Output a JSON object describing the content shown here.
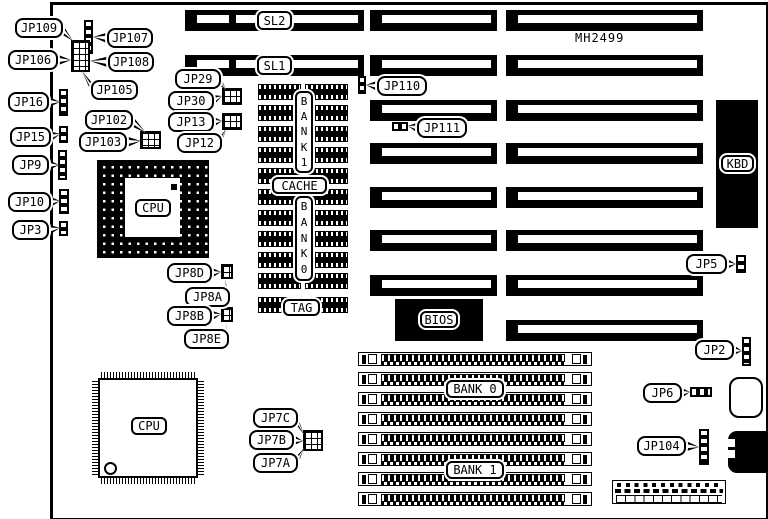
{
  "colors": {
    "ink": "#000000",
    "paper": "#ffffff"
  },
  "title": {
    "text": "MH2499",
    "x": 575,
    "y": 31
  },
  "board": {
    "x": 50,
    "y": 2,
    "w": 713,
    "h": 513,
    "border": [
      3,
      3,
      9,
      3
    ]
  },
  "slots": [
    {
      "id": "SL2",
      "x": 185,
      "y": 10,
      "w": 179,
      "h": 21,
      "divider": true
    },
    {
      "id": "SL1",
      "x": 185,
      "y": 55,
      "w": 179,
      "h": 21,
      "divider": true
    },
    {
      "id": "slot-m1",
      "x": 370,
      "y": 10,
      "w": 127,
      "h": 21
    },
    {
      "id": "slot-m2",
      "x": 370,
      "y": 55,
      "w": 127,
      "h": 21
    },
    {
      "id": "slot-m3",
      "x": 370,
      "y": 100,
      "w": 127,
      "h": 21
    },
    {
      "id": "slot-m4",
      "x": 370,
      "y": 143,
      "w": 127,
      "h": 21
    },
    {
      "id": "slot-m5",
      "x": 370,
      "y": 187,
      "w": 127,
      "h": 21
    },
    {
      "id": "slot-m6",
      "x": 370,
      "y": 230,
      "w": 127,
      "h": 21
    },
    {
      "id": "slot-m7",
      "x": 370,
      "y": 275,
      "w": 127,
      "h": 21
    },
    {
      "id": "slot-r1",
      "x": 506,
      "y": 10,
      "w": 197,
      "h": 21
    },
    {
      "id": "slot-r2",
      "x": 506,
      "y": 55,
      "w": 197,
      "h": 21
    },
    {
      "id": "slot-r3",
      "x": 506,
      "y": 100,
      "w": 197,
      "h": 21
    },
    {
      "id": "slot-r4",
      "x": 506,
      "y": 143,
      "w": 197,
      "h": 21
    },
    {
      "id": "slot-r5",
      "x": 506,
      "y": 187,
      "w": 197,
      "h": 21
    },
    {
      "id": "slot-r6",
      "x": 506,
      "y": 230,
      "w": 197,
      "h": 21
    },
    {
      "id": "slot-r7",
      "x": 506,
      "y": 275,
      "w": 197,
      "h": 21
    },
    {
      "id": "slot-r8",
      "x": 506,
      "y": 320,
      "w": 197,
      "h": 21
    }
  ],
  "component_labels": [
    {
      "id": "sl2",
      "text": "SL2",
      "x": 257,
      "y": 11,
      "w": 35,
      "h": 19
    },
    {
      "id": "sl1",
      "text": "SL1",
      "x": 257,
      "y": 56,
      "w": 35,
      "h": 19
    },
    {
      "id": "cpu-pga",
      "text": "CPU",
      "x": 135,
      "y": 199,
      "w": 36,
      "h": 18
    },
    {
      "id": "cpu-qfp",
      "text": "CPU",
      "x": 131,
      "y": 417,
      "w": 36,
      "h": 18
    },
    {
      "id": "kbd",
      "text": "KBD",
      "x": 721,
      "y": 155,
      "w": 33,
      "h": 17
    },
    {
      "id": "bios",
      "text": "BIOS",
      "x": 420,
      "y": 311,
      "w": 38,
      "h": 17
    },
    {
      "id": "cache",
      "text": "CACHE",
      "x": 272,
      "y": 177,
      "w": 55,
      "h": 17
    },
    {
      "id": "tag",
      "text": "TAG",
      "x": 283,
      "y": 299,
      "w": 37,
      "h": 17
    },
    {
      "id": "cache-bank1",
      "text": "BANK 1",
      "x": 295,
      "y": 91,
      "w": 18,
      "h": 82,
      "vertical": true
    },
    {
      "id": "cache-bank0",
      "text": "BANK 0",
      "x": 295,
      "y": 196,
      "w": 18,
      "h": 85,
      "vertical": true
    },
    {
      "id": "simm-bank0",
      "text": "BANK 0",
      "x": 446,
      "y": 380,
      "w": 58,
      "h": 18
    },
    {
      "id": "simm-bank1",
      "text": "BANK 1",
      "x": 446,
      "y": 461,
      "w": 58,
      "h": 18
    }
  ],
  "callouts": [
    {
      "id": "JP109",
      "text": "JP109",
      "x": 15,
      "y": 18,
      "w": 48,
      "h": 20,
      "side": "right",
      "target": [
        73,
        41
      ]
    },
    {
      "id": "JP107",
      "text": "JP107",
      "x": 107,
      "y": 28,
      "w": 46,
      "h": 20,
      "side": "left",
      "target": [
        93,
        37
      ]
    },
    {
      "id": "JP106",
      "text": "JP106",
      "x": 8,
      "y": 50,
      "w": 50,
      "h": 20,
      "side": "right",
      "target": [
        71,
        60
      ]
    },
    {
      "id": "JP108",
      "text": "JP108",
      "x": 108,
      "y": 52,
      "w": 46,
      "h": 20,
      "side": "left",
      "target": [
        90,
        61
      ]
    },
    {
      "id": "JP105",
      "text": "JP105",
      "x": 91,
      "y": 80,
      "w": 47,
      "h": 20,
      "side": "left",
      "target": [
        82,
        71
      ]
    },
    {
      "id": "JP16",
      "text": "JP16",
      "x": 8,
      "y": 92,
      "w": 41,
      "h": 20,
      "side": "right",
      "target": [
        60,
        102
      ]
    },
    {
      "id": "JP102",
      "text": "JP102",
      "x": 85,
      "y": 110,
      "w": 48,
      "h": 20,
      "side": "right",
      "target": [
        146,
        133
      ]
    },
    {
      "id": "JP15",
      "text": "JP15",
      "x": 10,
      "y": 127,
      "w": 41,
      "h": 20,
      "side": "right",
      "target": [
        60,
        134
      ]
    },
    {
      "id": "JP103",
      "text": "JP103",
      "x": 79,
      "y": 132,
      "w": 48,
      "h": 20,
      "side": "right",
      "target": [
        141,
        141
      ]
    },
    {
      "id": "JP9",
      "text": "JP9",
      "x": 12,
      "y": 155,
      "w": 37,
      "h": 20,
      "side": "right",
      "target": [
        59,
        165
      ]
    },
    {
      "id": "JP10",
      "text": "JP10",
      "x": 8,
      "y": 192,
      "w": 43,
      "h": 20,
      "side": "right",
      "target": [
        60,
        201
      ]
    },
    {
      "id": "JP3",
      "text": "JP3",
      "x": 12,
      "y": 220,
      "w": 37,
      "h": 20,
      "side": "right",
      "target": [
        60,
        228
      ]
    },
    {
      "id": "JP29",
      "text": "JP29",
      "x": 175,
      "y": 69,
      "w": 46,
      "h": 20,
      "side": "right",
      "target": [
        226,
        90
      ]
    },
    {
      "id": "JP30",
      "text": "JP30",
      "x": 168,
      "y": 91,
      "w": 46,
      "h": 20,
      "side": "right",
      "target": [
        222,
        96
      ]
    },
    {
      "id": "JP13",
      "text": "JP13",
      "x": 168,
      "y": 112,
      "w": 46,
      "h": 20,
      "side": "right",
      "target": [
        222,
        121
      ]
    },
    {
      "id": "JP12",
      "text": "JP12",
      "x": 177,
      "y": 133,
      "w": 45,
      "h": 20,
      "side": "right",
      "target": [
        226,
        129
      ]
    },
    {
      "id": "JP110",
      "text": "JP110",
      "x": 377,
      "y": 76,
      "w": 50,
      "h": 20,
      "side": "left",
      "target": [
        366,
        85
      ]
    },
    {
      "id": "JP111",
      "text": "JP111",
      "x": 417,
      "y": 118,
      "w": 50,
      "h": 20,
      "side": "left",
      "target": [
        408,
        126
      ]
    },
    {
      "id": "JP8D",
      "text": "JP8D",
      "x": 167,
      "y": 263,
      "w": 45,
      "h": 20,
      "side": "right",
      "target": [
        221,
        272
      ]
    },
    {
      "id": "JP8A",
      "text": "JP8A",
      "x": 185,
      "y": 287,
      "w": 45,
      "h": 20,
      "side": "right",
      "target": [
        225,
        280
      ]
    },
    {
      "id": "JP8B",
      "text": "JP8B",
      "x": 167,
      "y": 306,
      "w": 45,
      "h": 20,
      "side": "right",
      "target": [
        221,
        314
      ]
    },
    {
      "id": "JP8E",
      "text": "JP8E",
      "x": 184,
      "y": 329,
      "w": 45,
      "h": 20,
      "side": "right",
      "target": [
        226,
        323
      ]
    },
    {
      "id": "JP7C",
      "text": "JP7C",
      "x": 253,
      "y": 408,
      "w": 45,
      "h": 20,
      "side": "right",
      "target": [
        304,
        435
      ]
    },
    {
      "id": "JP7B",
      "text": "JP7B",
      "x": 249,
      "y": 430,
      "w": 45,
      "h": 20,
      "side": "right",
      "target": [
        303,
        441
      ]
    },
    {
      "id": "JP7A",
      "text": "JP7A",
      "x": 253,
      "y": 453,
      "w": 45,
      "h": 20,
      "side": "right",
      "target": [
        304,
        448
      ]
    },
    {
      "id": "JP5",
      "text": "JP5",
      "x": 686,
      "y": 254,
      "w": 41,
      "h": 20,
      "side": "right",
      "target": [
        736,
        264
      ]
    },
    {
      "id": "JP2",
      "text": "JP2",
      "x": 695,
      "y": 340,
      "w": 39,
      "h": 20,
      "side": "right",
      "target": [
        742,
        351
      ]
    },
    {
      "id": "JP6",
      "text": "JP6",
      "x": 643,
      "y": 383,
      "w": 39,
      "h": 20,
      "side": "right",
      "target": [
        690,
        392
      ]
    },
    {
      "id": "JP104",
      "text": "JP104",
      "x": 637,
      "y": 436,
      "w": 49,
      "h": 20,
      "side": "right",
      "target": [
        699,
        447
      ]
    }
  ],
  "jumpers": [
    {
      "id": "jmp-topleft-strip",
      "x": 84,
      "y": 20,
      "w": 9,
      "h": 34,
      "kind": "strip-v"
    },
    {
      "id": "jmp-topleft-block",
      "x": 71,
      "y": 40,
      "w": 19,
      "h": 32,
      "kind": "grid"
    },
    {
      "id": "jmp-jp16",
      "x": 59,
      "y": 89,
      "w": 9,
      "h": 27,
      "kind": "strip-v"
    },
    {
      "id": "jmp-jp102",
      "x": 140,
      "y": 131,
      "w": 21,
      "h": 18,
      "kind": "grid"
    },
    {
      "id": "jmp-jp15",
      "x": 59,
      "y": 126,
      "w": 9,
      "h": 17,
      "kind": "strip-v"
    },
    {
      "id": "jmp-jp9",
      "x": 58,
      "y": 150,
      "w": 9,
      "h": 30,
      "kind": "strip-v"
    },
    {
      "id": "jmp-jp10",
      "x": 59,
      "y": 189,
      "w": 10,
      "h": 25,
      "kind": "strip-v"
    },
    {
      "id": "jmp-jp3",
      "x": 59,
      "y": 221,
      "w": 9,
      "h": 15,
      "kind": "strip-v"
    },
    {
      "id": "jmp-jp30",
      "x": 222,
      "y": 88,
      "w": 20,
      "h": 17,
      "kind": "grid"
    },
    {
      "id": "jmp-jp13",
      "x": 222,
      "y": 113,
      "w": 20,
      "h": 17,
      "kind": "grid"
    },
    {
      "id": "jmp-jp110",
      "x": 358,
      "y": 76,
      "w": 8,
      "h": 18,
      "kind": "strip-v"
    },
    {
      "id": "jmp-jp111",
      "x": 392,
      "y": 122,
      "w": 16,
      "h": 9,
      "kind": "strip-h"
    },
    {
      "id": "jmp-jp8d",
      "x": 221,
      "y": 264,
      "w": 12,
      "h": 15,
      "kind": "grid"
    },
    {
      "id": "jmp-jp8b",
      "x": 221,
      "y": 307,
      "w": 12,
      "h": 15,
      "kind": "grid"
    },
    {
      "id": "jmp-jp7",
      "x": 303,
      "y": 430,
      "w": 20,
      "h": 21,
      "kind": "grid"
    },
    {
      "id": "jmp-jp5",
      "x": 736,
      "y": 255,
      "w": 10,
      "h": 18,
      "kind": "strip-v"
    },
    {
      "id": "jmp-jp2",
      "x": 742,
      "y": 337,
      "w": 9,
      "h": 29,
      "kind": "strip-v"
    },
    {
      "id": "jmp-jp6",
      "x": 690,
      "y": 387,
      "w": 22,
      "h": 10,
      "kind": "strip-h"
    },
    {
      "id": "jmp-jp104",
      "x": 699,
      "y": 429,
      "w": 10,
      "h": 36,
      "kind": "strip-v"
    }
  ],
  "cache_block": {
    "col_xs": [
      258,
      305
    ],
    "chip_w": 43,
    "chip_h": 16,
    "row_ys": [
      84,
      105,
      126,
      147,
      168,
      189,
      210,
      231,
      252,
      273
    ],
    "tag_row_y": 297
  },
  "pga_socket": {
    "x": 97,
    "y": 160,
    "w": 112,
    "h": 98,
    "inner": {
      "x": 125,
      "y": 178,
      "w": 55,
      "h": 59
    },
    "pin1_dot": {
      "x": 171,
      "y": 184,
      "w": 6,
      "h": 6
    }
  },
  "qfp_chip": {
    "x": 98,
    "y": 378,
    "w": 100,
    "h": 100,
    "pin_len": 6,
    "pin1_circle": {
      "x": 104,
      "y": 462,
      "d": 9
    }
  },
  "simm_banks": {
    "x": 358,
    "w": 234,
    "h": 14,
    "row_ys": [
      352,
      372,
      392,
      412,
      432,
      452,
      472,
      492
    ]
  },
  "bios": {
    "x": 395,
    "y": 299,
    "w": 88,
    "h": 42
  },
  "kbd": {
    "x": 716,
    "y": 100,
    "w": 42,
    "h": 128
  },
  "din_connector": {
    "x": 728,
    "y": 431,
    "w": 38,
    "h": 42,
    "notches": [
      [
        728,
        439,
        7,
        8
      ],
      [
        728,
        450,
        7,
        8
      ]
    ]
  },
  "battery": {
    "x": 729,
    "y": 377,
    "w": 34,
    "h": 41
  },
  "power_strip": {
    "x": 612,
    "y": 480,
    "w": 114,
    "h": 24
  }
}
